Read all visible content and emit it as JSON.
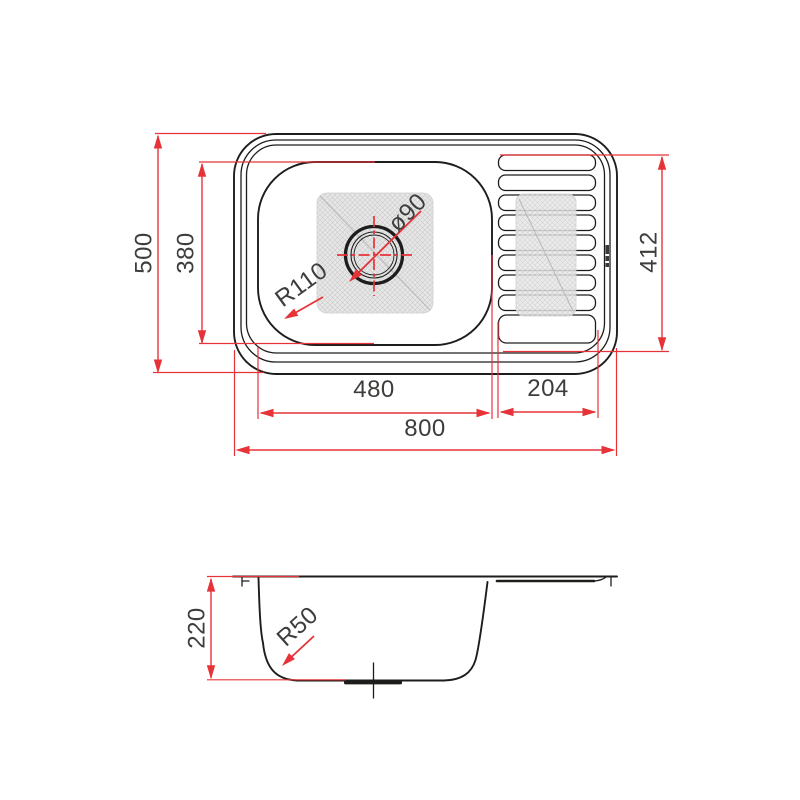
{
  "drawing": {
    "type": "technical-dimension-drawing",
    "subject": "kitchen sink with single bowl and drainboard",
    "colors": {
      "dimension_red": "#e63338",
      "line_black": "#1d1d1b",
      "text_gray": "#3d3d3b",
      "hatch_gray": "#e7e7e7",
      "background": "#ffffff"
    },
    "top_view": {
      "dimensions": {
        "overall_width": {
          "label": "800"
        },
        "overall_depth": {
          "label": "500"
        },
        "bowl_width": {
          "label": "480"
        },
        "bowl_depth": {
          "label": "380"
        },
        "drainboard_width": {
          "label": "204"
        },
        "drainboard_depth": {
          "label": "412"
        },
        "drain_diameter": {
          "label": "ø90"
        },
        "bowl_corner_radius": {
          "label": "R110"
        }
      }
    },
    "side_view": {
      "dimensions": {
        "bowl_height": {
          "label": "220"
        },
        "bottom_corner_radius": {
          "label": "R50"
        }
      }
    },
    "icons": {
      "brand_mark": "manufacturer-logo-mark"
    }
  }
}
